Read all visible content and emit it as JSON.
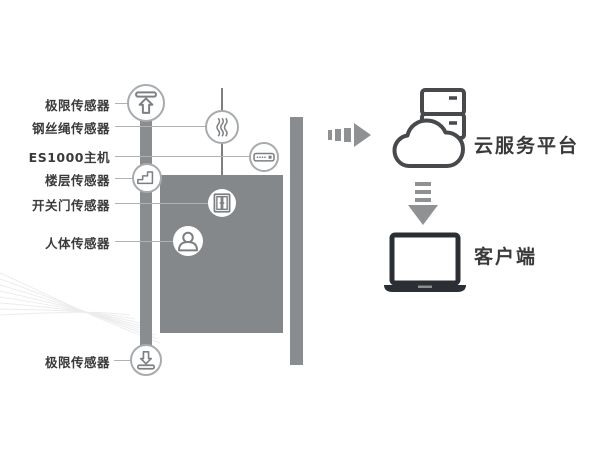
{
  "diagram_title": "elevator-iot-monitoring-diagram",
  "sensors": [
    {
      "label": "极限传感器",
      "icon": "limit-up-sensor-icon"
    },
    {
      "label": "钢丝绳传感器",
      "icon": "wire-rope-sensor-icon"
    },
    {
      "label": "ES1000主机",
      "icon": "es1000-host-icon"
    },
    {
      "label": "楼层传感器",
      "icon": "floor-sensor-icon"
    },
    {
      "label": "开关门传感器",
      "icon": "door-open-close-sensor-icon"
    },
    {
      "label": "人体传感器",
      "icon": "human-body-sensor-icon"
    },
    {
      "label": "极限传感器",
      "icon": "limit-down-sensor-icon"
    }
  ],
  "flow": {
    "cloud_label": "云服务平台",
    "client_label": "客户端",
    "cloud_icon": "cloud-server-icon",
    "client_icon": "laptop-icon",
    "arrow_right_icon": "dashed-arrow-right-icon",
    "arrow_down_icon": "dashed-arrow-down-icon"
  },
  "colors": {
    "structure_gray": "#85888b",
    "rail_gray": "#8a8d90",
    "icon_stroke": "#7d8083",
    "circle_border": "#a8abad",
    "label_text": "#3a3a3a",
    "arrow_gray": "#8f9193",
    "dark_outline": "#47494c",
    "laptop_dark": "#2b2f33",
    "connector_line": "#b0b2b4",
    "watermark": "#ececec"
  }
}
